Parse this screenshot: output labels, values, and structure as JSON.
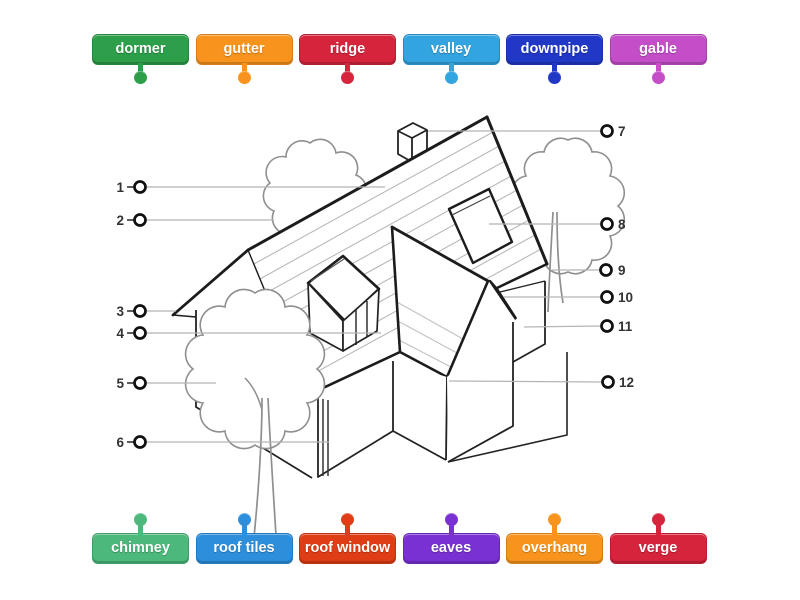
{
  "activity": {
    "type": "labelled-diagram",
    "subject": "roof parts"
  },
  "top_labels": [
    {
      "text": "dormer",
      "color": "#2d9e49"
    },
    {
      "text": "gutter",
      "color": "#f8941d"
    },
    {
      "text": "ridge",
      "color": "#d5243c"
    },
    {
      "text": "valley",
      "color": "#32a4e0"
    },
    {
      "text": "downpipe",
      "color": "#2138c6"
    },
    {
      "text": "gable",
      "color": "#c44ec8"
    }
  ],
  "bottom_labels": [
    {
      "text": "chimney",
      "color": "#4cb87b"
    },
    {
      "text": "roof tiles",
      "color": "#2d8fdc"
    },
    {
      "text": "roof window",
      "color": "#df3d15"
    },
    {
      "text": "eaves",
      "color": "#7a31d3"
    },
    {
      "text": "overhang",
      "color": "#f8941d"
    },
    {
      "text": "verge",
      "color": "#d5243c"
    }
  ],
  "markers": {
    "left": [
      "1",
      "2",
      "3",
      "4",
      "5",
      "6"
    ],
    "right": [
      "7",
      "8",
      "9",
      "10",
      "11",
      "12"
    ]
  }
}
